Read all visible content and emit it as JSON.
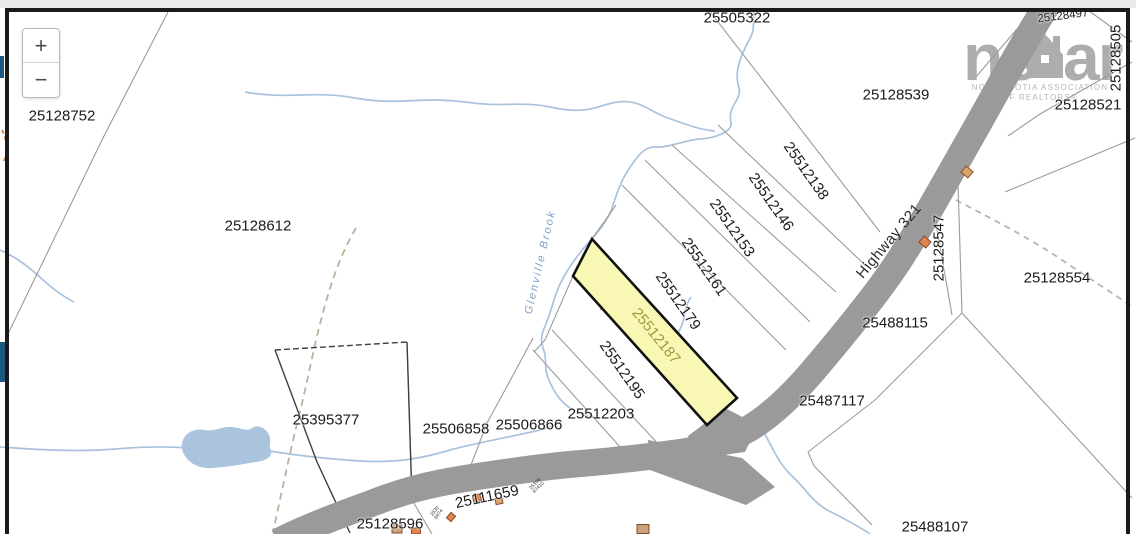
{
  "controls": {
    "zoom_in_label": "+",
    "zoom_out_label": "−"
  },
  "watermark": {
    "brand_left": "ns",
    "brand_right": "ar",
    "house_icon": "house-icon",
    "tagline_line1": "NOVA SCOTIA ASSOCIATION",
    "tagline_line2": "OF REALTORS®"
  },
  "map": {
    "highlighted_parcel_id": "25512187",
    "road_label": {
      "text": "Highway 321",
      "x": 889,
      "y": 241,
      "rot": -50
    },
    "water_label": {
      "text": "Glenville Brook",
      "x": 541,
      "y": 262,
      "rot": -77
    },
    "parcel_labels": [
      {
        "text": "25128752",
        "x": 62,
        "y": 116,
        "rot": 0,
        "kind": "plain"
      },
      {
        "text": "25128612",
        "x": 258,
        "y": 226,
        "rot": 0,
        "kind": "plain"
      },
      {
        "text": "25505322",
        "x": 737,
        "y": 18,
        "rot": 0,
        "kind": "plain"
      },
      {
        "text": "25128539",
        "x": 896,
        "y": 95,
        "rot": 0,
        "kind": "plain"
      },
      {
        "text": "25128497",
        "x": 1063,
        "y": 17,
        "rot": -7,
        "kind": "small"
      },
      {
        "text": "25128505",
        "x": 1116,
        "y": 58,
        "rot": -90,
        "kind": "plain"
      },
      {
        "text": "25128521",
        "x": 1088,
        "y": 105,
        "rot": 0,
        "kind": "plain"
      },
      {
        "text": "25128554",
        "x": 1057,
        "y": 278,
        "rot": 0,
        "kind": "plain"
      },
      {
        "text": "25128547",
        "x": 939,
        "y": 248,
        "rot": -90,
        "kind": "plain"
      },
      {
        "text": "25488115",
        "x": 895,
        "y": 323,
        "rot": 0,
        "kind": "plain"
      },
      {
        "text": "25487117",
        "x": 832,
        "y": 401,
        "rot": 0,
        "kind": "plain"
      },
      {
        "text": "25488107",
        "x": 935,
        "y": 527,
        "rot": 0,
        "kind": "plain"
      },
      {
        "text": "25512138",
        "x": 806,
        "y": 171,
        "rot": 55,
        "kind": "plain"
      },
      {
        "text": "25512146",
        "x": 771,
        "y": 202,
        "rot": 55,
        "kind": "plain"
      },
      {
        "text": "25512153",
        "x": 732,
        "y": 228,
        "rot": 55,
        "kind": "plain"
      },
      {
        "text": "25512161",
        "x": 704,
        "y": 267,
        "rot": 55,
        "kind": "plain"
      },
      {
        "text": "25512179",
        "x": 678,
        "y": 301,
        "rot": 55,
        "kind": "plain"
      },
      {
        "text": "25512187",
        "x": 656,
        "y": 336,
        "rot": 51,
        "kind": "hl"
      },
      {
        "text": "25512195",
        "x": 622,
        "y": 370,
        "rot": 55,
        "kind": "plain"
      },
      {
        "text": "25512203",
        "x": 601,
        "y": 414,
        "rot": 0,
        "kind": "plain"
      },
      {
        "text": "25506858",
        "x": 456,
        "y": 429,
        "rot": 0,
        "kind": "plain"
      },
      {
        "text": "25506866",
        "x": 529,
        "y": 425,
        "rot": 0,
        "kind": "plain"
      },
      {
        "text": "25395377",
        "x": 326,
        "y": 420,
        "rot": 0,
        "kind": "plain"
      },
      {
        "text": "25128596",
        "x": 390,
        "y": 524,
        "rot": 0,
        "kind": "plain"
      },
      {
        "text": "25111659",
        "x": 487,
        "y": 497,
        "rot": -12,
        "kind": "plain"
      }
    ],
    "tiny_labels": [
      {
        "lines": [
          "25306",
          "87410"
        ],
        "x": 537,
        "y": 486,
        "rot": -45
      },
      {
        "lines": [
          "2530",
          "6874"
        ],
        "x": 437,
        "y": 513,
        "rot": -52
      }
    ],
    "buildings": [
      {
        "x": 967,
        "y": 172,
        "w": 9,
        "h": 8,
        "rot": 40,
        "fill": "#d9a468"
      },
      {
        "x": 925,
        "y": 242,
        "w": 9,
        "h": 8,
        "rot": 42,
        "fill": "#de8549"
      },
      {
        "x": 477,
        "y": 498,
        "w": 8,
        "h": 7,
        "rot": -12,
        "fill": "#de8549"
      },
      {
        "x": 499,
        "y": 501,
        "w": 7,
        "h": 6,
        "rot": -12,
        "fill": "#d9a468"
      },
      {
        "x": 451,
        "y": 517,
        "w": 7,
        "h": 6,
        "rot": -50,
        "fill": "#de8549"
      },
      {
        "x": 397,
        "y": 529,
        "w": 10,
        "h": 8,
        "rot": 0,
        "fill": "#c9a478"
      },
      {
        "x": 416,
        "y": 531,
        "w": 9,
        "h": 6,
        "rot": 0,
        "fill": "#de8549"
      },
      {
        "x": 643,
        "y": 529,
        "w": 12,
        "h": 9,
        "rot": 0,
        "fill": "#c9a478"
      }
    ],
    "colors": {
      "parcel_line": "#9b9b9b",
      "survey_line": "#3f3f3f",
      "road": "#9a9a9a",
      "water": "#a9c2dd",
      "pond_fill": "#aac4de",
      "highlight_fill": "#f8f8b4",
      "highlight_border": "#111111",
      "highlight_label": "#9a9a3f",
      "label": "#1b1b1b",
      "trail_tan": "#bdb09c",
      "trail_gray": "#b5b5b5",
      "trail_orange": "#d08a4e",
      "building_outline": "#8a4a30",
      "frame": "#1a1a1a",
      "watermark_gray": "#a2a2a2",
      "edge_navy": "#1d5a82",
      "top_strip": "#e9e9e9"
    }
  }
}
